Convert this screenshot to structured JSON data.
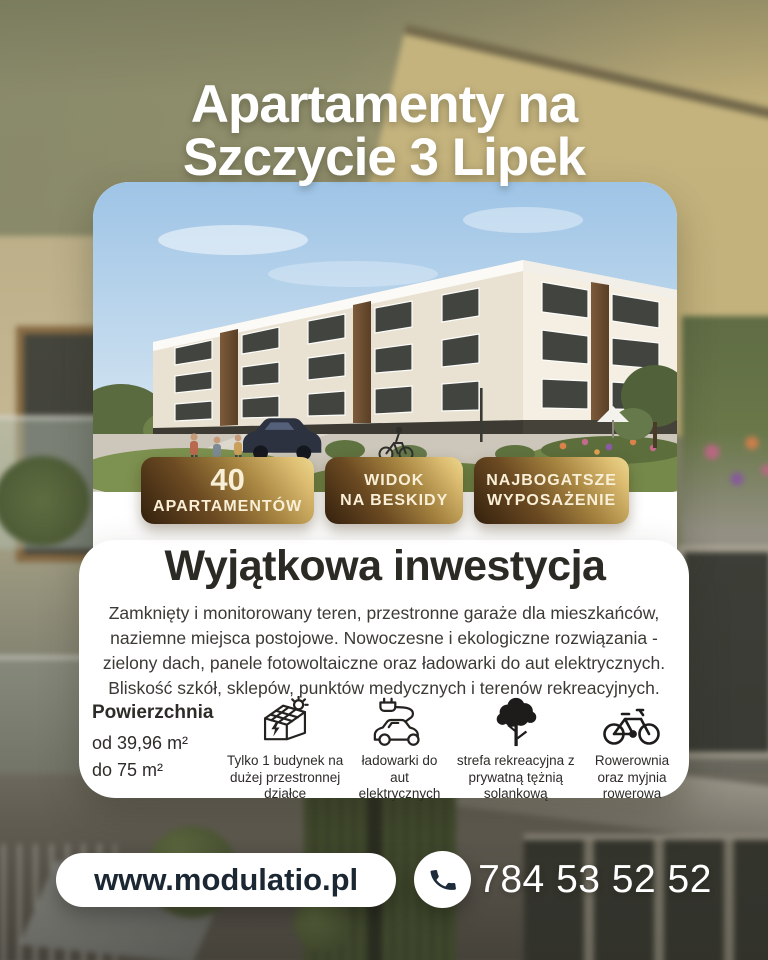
{
  "poster": {
    "title": {
      "line1": "Apartamenty na",
      "line2": "Szczycie 3 Lipek"
    },
    "badges": [
      {
        "line1": "40",
        "line2": "APARTAMENTÓW"
      },
      {
        "line1": "WIDOK",
        "line2": "NA BESKIDY"
      },
      {
        "line1": "NAJBOGATSZE",
        "line2": "WYPOSAŻENIE"
      }
    ],
    "heading": "Wyjątkowa inwestycja",
    "description": "Zamknięty i monitorowany teren, przestronne garaże dla mieszkańców, naziemne miejsca postojowe. Nowoczesne i ekologiczne rozwiązania - zielony dach, panele fotowoltaiczne oraz ładowarki do aut elektrycznych. Bliskość szkół, sklepów, punktów medycznych i terenów rekreacyjnych.",
    "area": {
      "label": "Powierzchnia",
      "from": "od 39,96 m²",
      "to": "do 75 m²"
    },
    "features": [
      {
        "icon": "solar-house-icon",
        "label": "Tylko 1 budynek na dużej przestronnej działce"
      },
      {
        "icon": "ev-charger-icon",
        "label": "ładowarki do aut elektrycznych"
      },
      {
        "icon": "tree-icon",
        "label": "strefa rekreacyjna z prywatną tężnią solankową"
      },
      {
        "icon": "bicycle-icon",
        "label": "Rowerownia oraz myjnia rowerowa"
      }
    ],
    "contact": {
      "website": "www.modulatio.pl",
      "phone": "784 53 52 52"
    },
    "colors": {
      "gold_dark": "#33200d",
      "gold_light": "#ecd88f",
      "navy": "#1e2b3a",
      "card": "#ffffff"
    }
  }
}
